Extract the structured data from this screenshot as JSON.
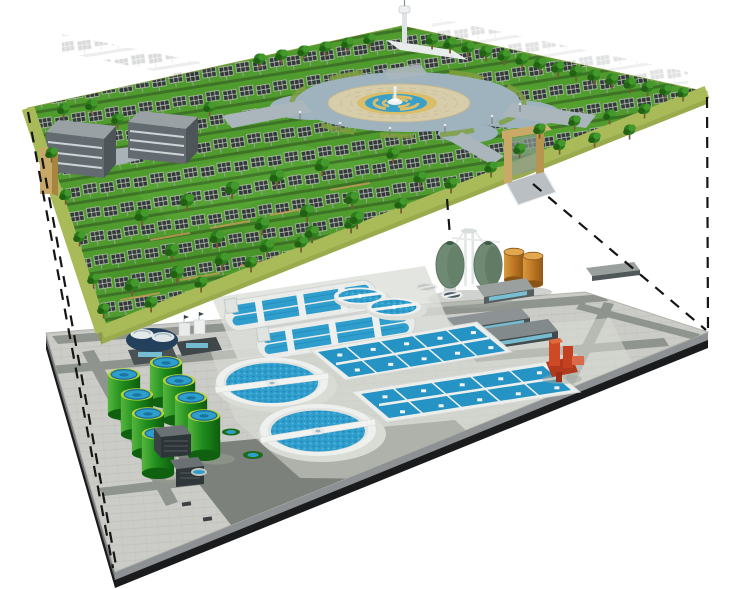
{
  "scene": {
    "title": "Cutaway illustration: underground wastewater treatment plant beneath a solar-panel park",
    "upper_level": {
      "label": "ground-level solar park",
      "elements": [
        "solar-panel-arrays",
        "trees",
        "office-buildings",
        "central-fountain-plaza",
        "observation-tower",
        "entrance-gate",
        "perimeter-lawn-rim"
      ],
      "building_count": 2,
      "grass_color": "#4f9b2d",
      "rim_color": "#a9ba58",
      "panel_color": "#303437",
      "plaza": {
        "pond_color": "#9fb3bf",
        "island_color": "#d8cdab",
        "fountain_ring_gold": "#d9bd69",
        "fountain_ring_blue": "#3aa0ca"
      }
    },
    "lower_level": {
      "label": "underground treatment works",
      "elements": [
        "oxidation-ditches",
        "circular-clarifiers",
        "aeration-basins",
        "egg-digesters",
        "green-storage-tanks",
        "fuel-tanks",
        "pump-station",
        "service-buildings",
        "substations"
      ],
      "green_tank_count": 8,
      "large_clarifier_count": 2,
      "medium_clarifier_count": 2,
      "small_covered_tank_count": 2,
      "digester_count": 2,
      "orange_tank_count": 2,
      "aeration_basin_count": 2,
      "oxidation_ditch_count": 2,
      "paving_color": "#cbccc7",
      "road_color": "#8f948e",
      "water_color": "#2f9ecd",
      "tank_green": "#2f9e2f",
      "digester_color": "#6f8a72",
      "accent_orange": "#c87f2a",
      "accent_red": "#c4411f"
    },
    "projection_lines": {
      "style": "dashed",
      "color": "#151515",
      "count": 5
    }
  }
}
